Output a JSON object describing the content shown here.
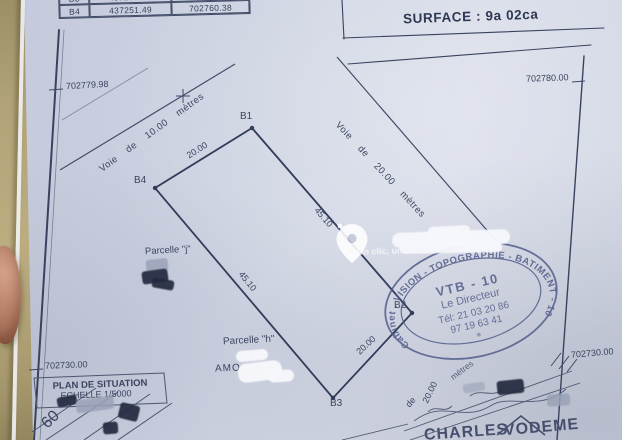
{
  "surface_label": "SURFACE : 9a 02ca",
  "coordinate_table": {
    "rows": [
      {
        "point": "B3",
        "x": "437270.96",
        "y": "702725.40"
      },
      {
        "point": "B4",
        "x": "437251.49",
        "y": "702760.38"
      }
    ]
  },
  "grid": {
    "left_top": "702779.98",
    "right_top": "702780.00",
    "left_bottom": "702730.00",
    "right_bottom": "702730.00"
  },
  "parcel": {
    "point_b1": "B1",
    "point_b2": "B2",
    "point_b3": "B3",
    "point_b4": "B4",
    "dim_top": "20.00",
    "dim_right": "45.10",
    "dim_left": "45.10",
    "dim_bottom": "20.00",
    "parcelle_j": "Parcelle \"j\"",
    "parcelle_h": "Parcelle \"h\"",
    "owner_fragment": "AMO",
    "fragment_s": "\"s",
    "voie_10": "Voie de 10.00 mètres",
    "voie_20": "Voie de 20.00 mètres"
  },
  "bottom_road": {
    "de": "de",
    "dim": "20.00",
    "metres": "mètres"
  },
  "situation": {
    "title": "PLAN DE SITUATION",
    "scale": "ECHELLE 1/5000",
    "road_number": "60"
  },
  "stamp": {
    "ring": "Cabinet . VISION - TOPOGRAPHIE - BATIMENT - 10",
    "code": "VTB - 10",
    "role": "Le Directeur",
    "phone1": "Tél: 21 03 20 86",
    "phone2": "97 19 63 41",
    "star": "✳"
  },
  "watermark_caption": "Un clic, un...",
  "signature": {
    "first": "CHARLES",
    "last": "VODEME"
  },
  "colors": {
    "ink": "#3d4763",
    "stamp": "#4d5886",
    "paper": "#ccd2e1",
    "background": "#ac9e73"
  }
}
